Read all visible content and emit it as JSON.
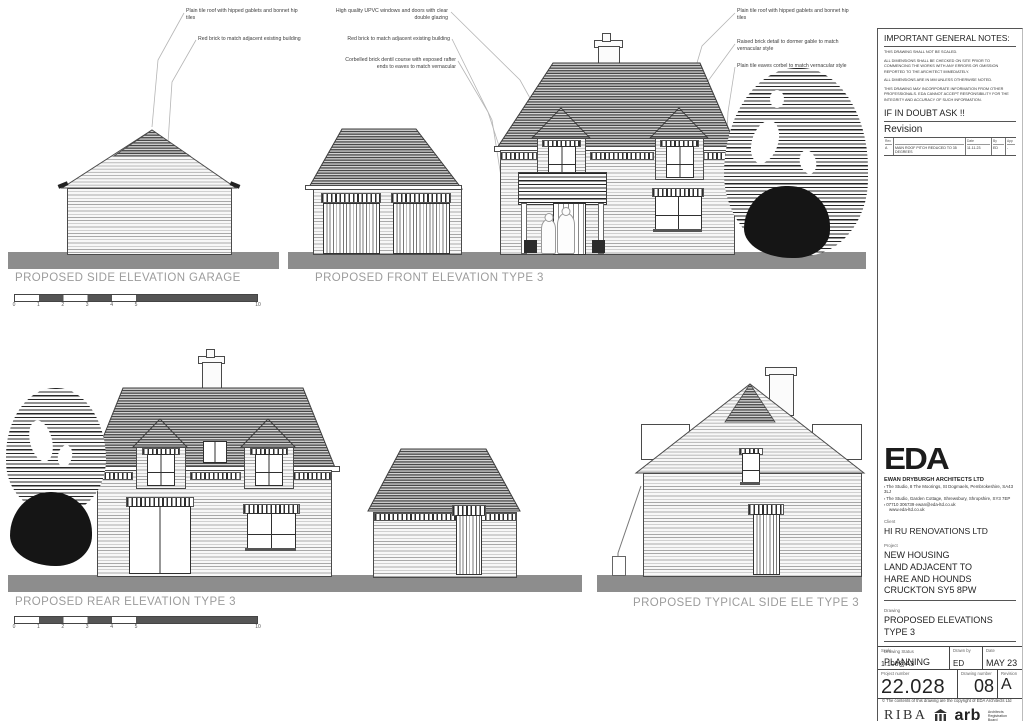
{
  "colors": {
    "ground": "#8d8d8d",
    "label_gray": "#9c9c9c",
    "line": "#4a4a4a",
    "leader": "#b5b5b5"
  },
  "annotations": {
    "a1": "Plain tile roof with hipped gablets and bonnet hip tiles",
    "a2": "Red brick to match adjacent existing building",
    "a3": "High quality UPVC windows and doors with clear double glazing",
    "a4": "Red brick to match adjacent existing building",
    "a5": "Corbelled brick dentil course with exposed rafter ends to eaves to match vernacular",
    "a6": "Plain tile roof with hipped gablets and bonnet hip tiles",
    "a7": "Raised brick detail to dormer gable to match vernacular style",
    "a8": "Plain tile eaves corbel to match vernacular style"
  },
  "labels": {
    "side_garage": "PROPOSED SIDE ELEVATION GARAGE",
    "front": "PROPOSED FRONT ELEVATION TYPE 3",
    "rear": "PROPOSED REAR ELEVATION TYPE 3",
    "typical_side": "PROPOSED TYPICAL SIDE ELE TYPE 3"
  },
  "scalebar": {
    "ticks": [
      "0",
      "1",
      "2",
      "3",
      "4",
      "5",
      "10"
    ]
  },
  "title_block": {
    "notes_title": "IMPORTANT GENERAL NOTES:",
    "notes": [
      "THIS DRAWING SHALL NOT BE SCALED.",
      "ALL DIMENSIONS SHALL BE CHECKED ON SITE PRIOR TO COMMENCING THE WORKS WITH ANY ERRORS OR OMISSION REPORTED TO THE ARCHITECT IMMEDIATELY.",
      "ALL DIMENSIONS ARE IN MM UNLESS OTHERWISE NOTED.",
      "THIS DRAWING MAY INCORPORATE INFORMATION FROM OTHER PROFESSIONALS. EDA CANNOT ACCEPT RESPONSIBILITY FOR THE INTEGRITY AND ACCURACY OF SUCH INFORMATION."
    ],
    "if_in_doubt": "IF IN DOUBT ASK !!",
    "revision_title": "Revision",
    "revision_headers": {
      "rev": "Rev",
      "date": "Date",
      "by": "By",
      "app": "App"
    },
    "revision_row": {
      "rev": "A",
      "description": "MAIN ROOF PITCH REDUCED TO 35 DEGREES",
      "date": "11.11.23",
      "by": "ED",
      "app": "-"
    },
    "firm": {
      "logo": "EDA",
      "name": "EWAN DRYBURGH ARCHITECTS LTD",
      "address1": "The Studio, 8 The Moorings, St Dogmaels, Pembrokeshire, SA43 3LJ",
      "address2": "The Studio, Garden Cottage, Shrewsbury, Shropshire, SY3 7EP",
      "phone_email": "07710 306739   ewan@eda-ltd.co.uk",
      "website": "www.eda-ltd.co.uk"
    },
    "client_label": "Client",
    "client": "HI RU RENOVATIONS LTD",
    "project_label": "Project",
    "project": "NEW HOUSING\nLAND ADJACENT TO\nHARE AND HOUNDS\nCRUCKTON SY5 8PW",
    "drawing_label": "Drawing",
    "drawing": "PROPOSED ELEVATIONS\nTYPE 3",
    "status_label": "Drawing Status",
    "status": "PLANNING",
    "scale_label": "Scale",
    "scale": "1:100@A3",
    "drawn_label": "Drawn by",
    "drawn": "ED",
    "date_label": "Date",
    "date": "MAY 23",
    "project_no_label": "Project number",
    "project_no": "22.028",
    "drawing_no_label": "Drawing number",
    "drawing_no": "08",
    "revision_label": "Revision",
    "revision": "A",
    "copyright": "© The contents of this drawing are the copyright of EDA Architects Ltd",
    "riba": "RIBA",
    "arb": "arb",
    "arb_caption": "Architects\nRegistration\nBoard"
  }
}
